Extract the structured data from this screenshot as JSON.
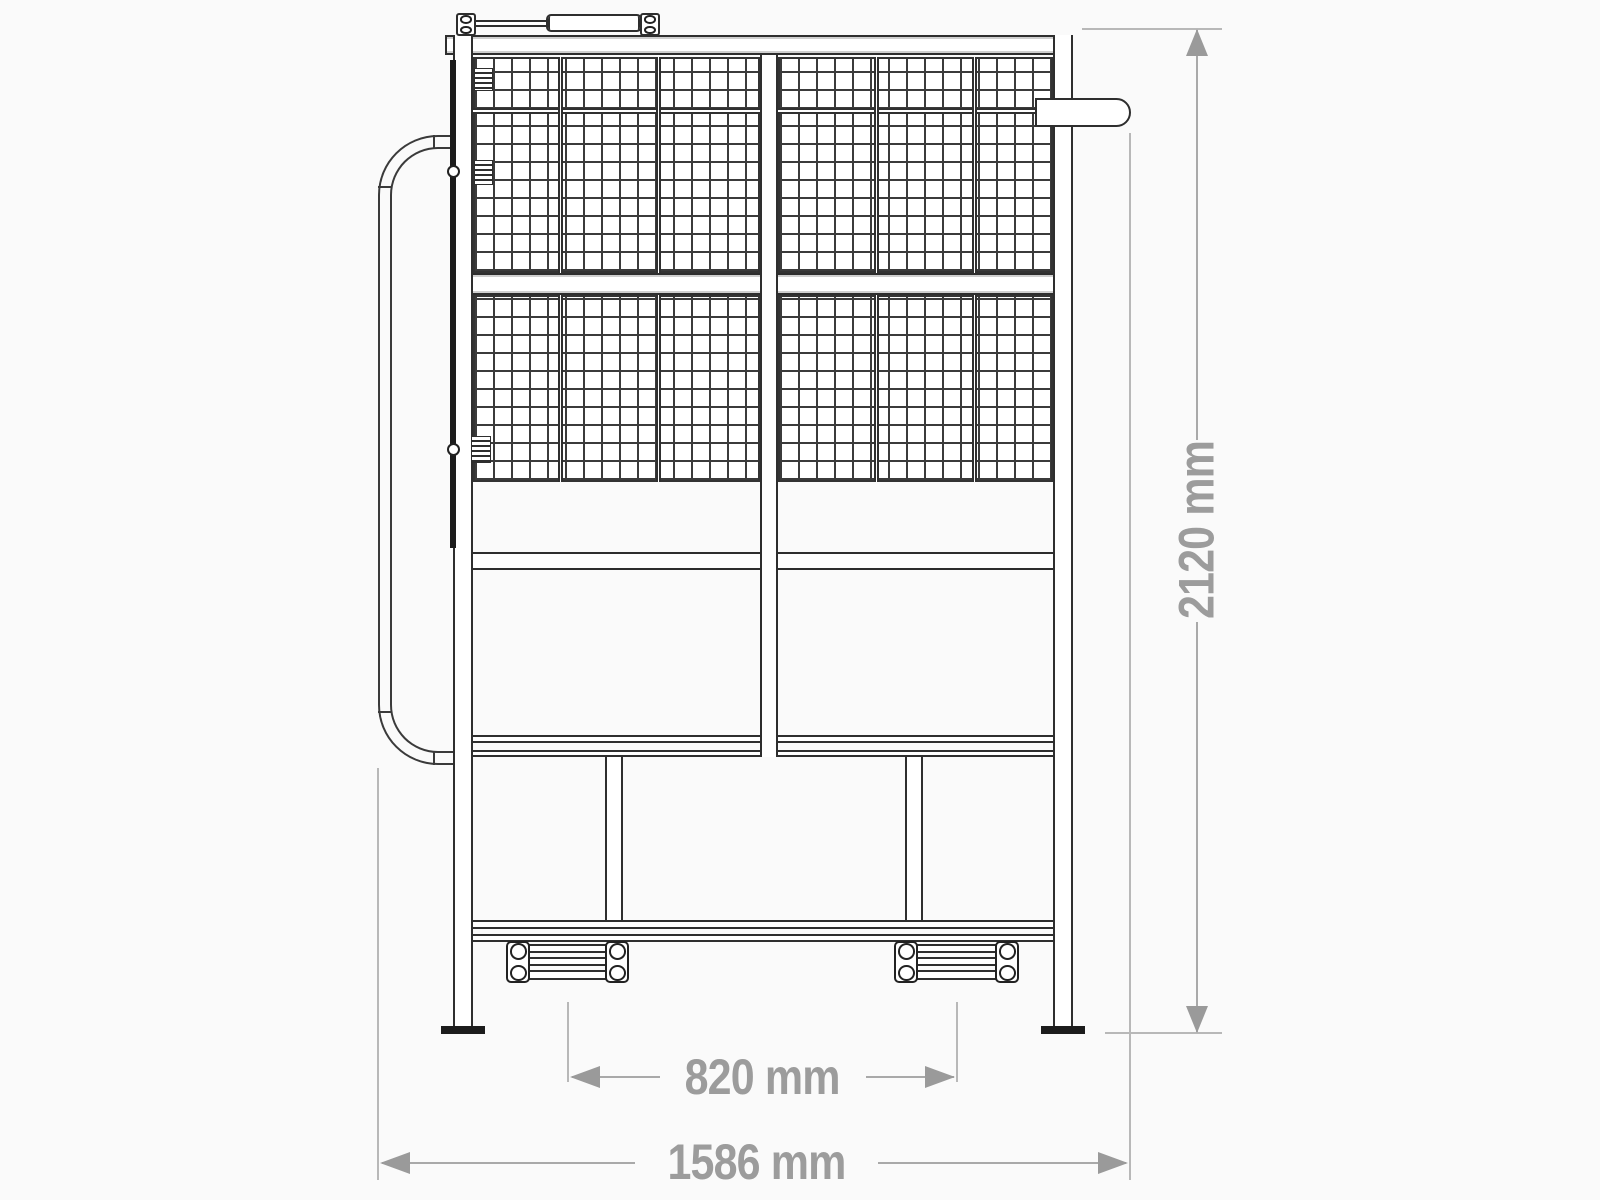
{
  "diagram": {
    "kind": "technical-drawing-front-elevation-mesh-safety-cage",
    "line_color": "#2e2e2e",
    "mesh_color": "#3b3b3b",
    "dim_color": "#9c9c9c",
    "background": "#fafafa",
    "labels": {
      "overall_height": "2120 mm",
      "bracket_spacing": "820 mm",
      "overall_width": "1586 mm"
    }
  }
}
